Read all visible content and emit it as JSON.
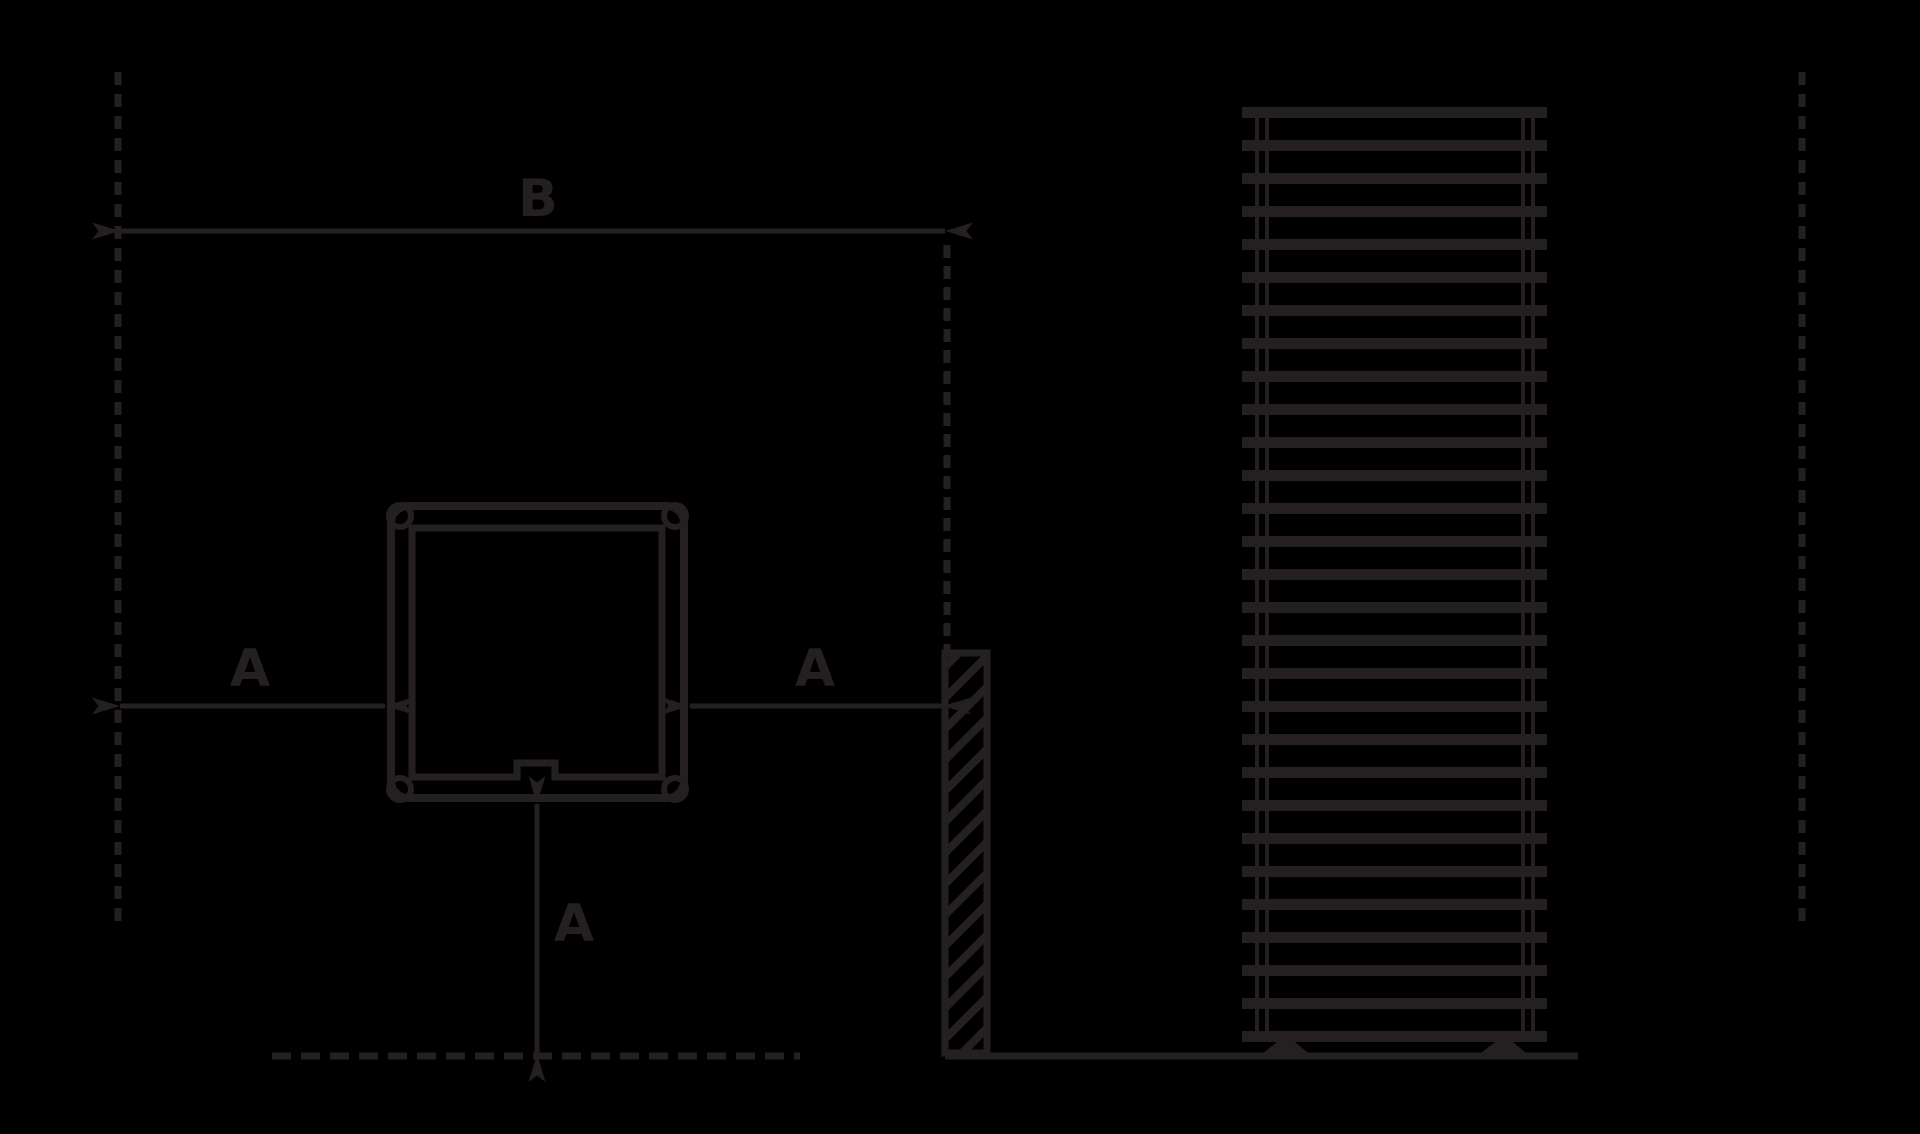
{
  "colors": {
    "background": "#000000",
    "line": "#241f21"
  },
  "diagram": {
    "kind": "installation-clearance-drawing",
    "labels": {
      "b_top": "B",
      "a_left": "A",
      "a_right": "A",
      "a_bottom": "A"
    },
    "radiator": {
      "bar_count": 29
    }
  }
}
